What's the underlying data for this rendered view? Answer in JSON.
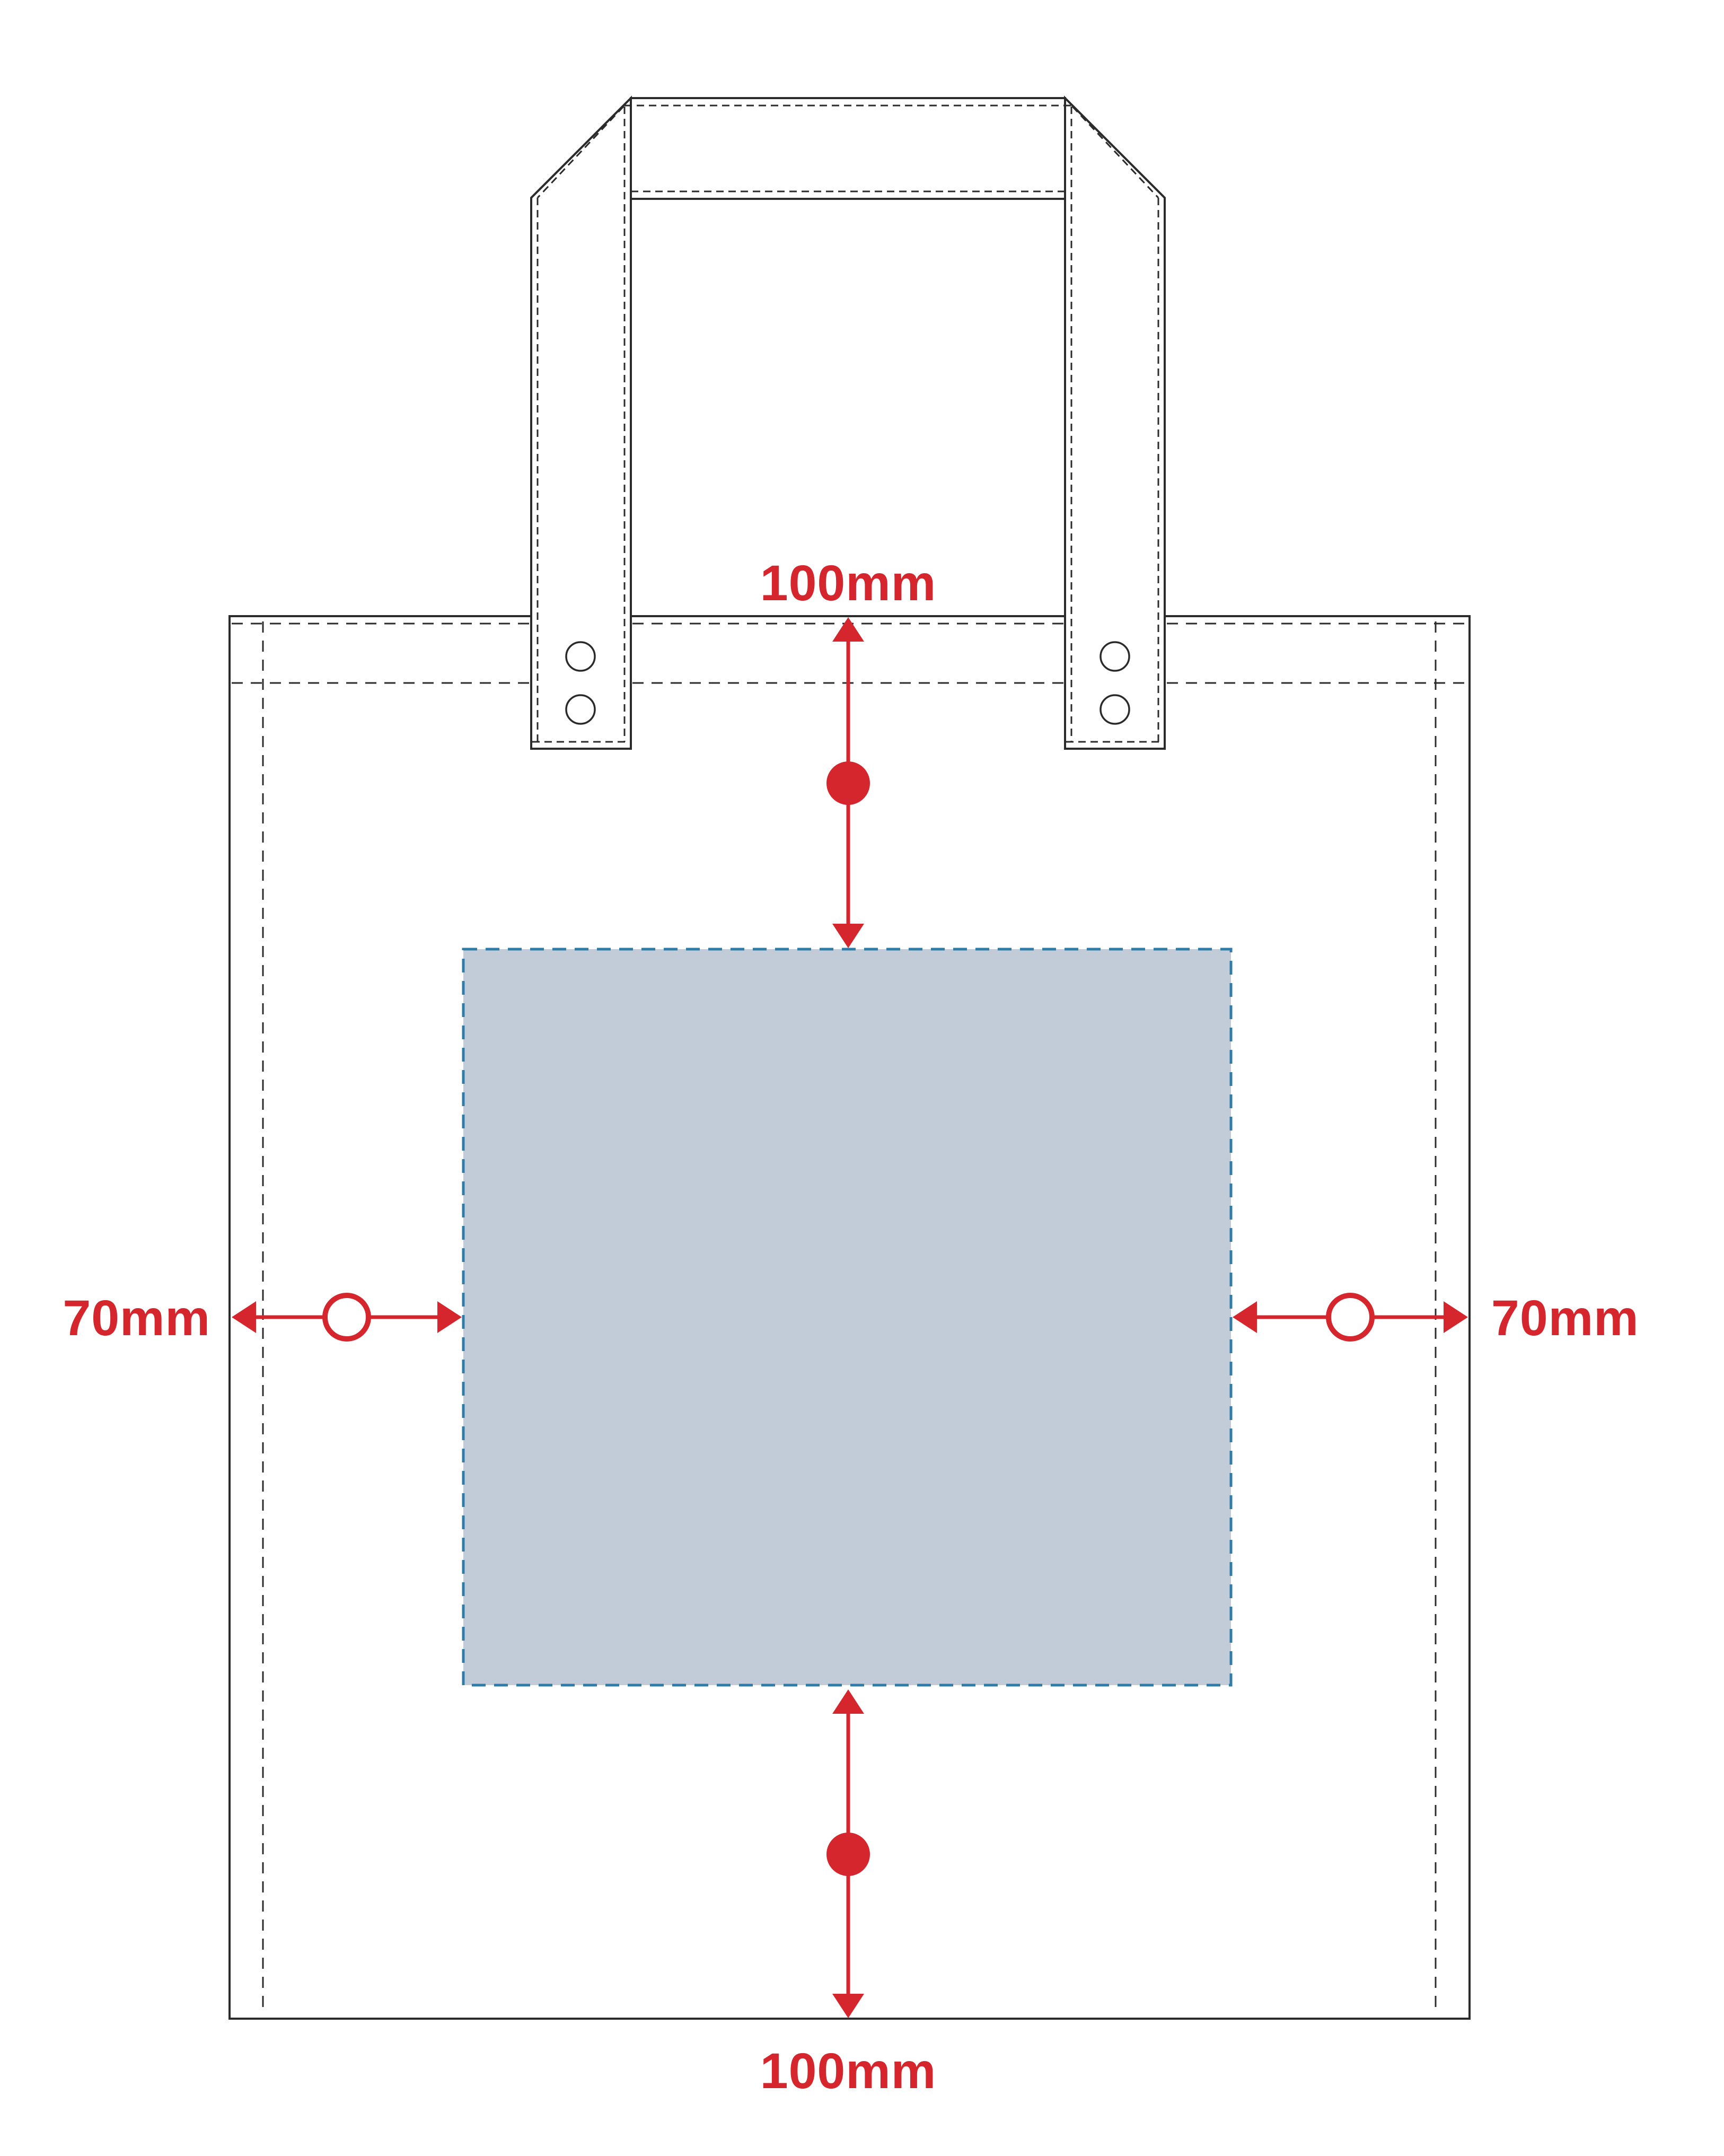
{
  "labels": {
    "top_margin": "100mm",
    "bottom_margin": "100mm",
    "left_margin": "70mm",
    "right_margin": "70mm"
  },
  "colors": {
    "accent_red": "#d4262c",
    "print_area_fill": "#c2ccd9",
    "print_area_border": "#2f7ca8",
    "outline_dark": "#2b2b2b",
    "background": "#ffffff"
  }
}
